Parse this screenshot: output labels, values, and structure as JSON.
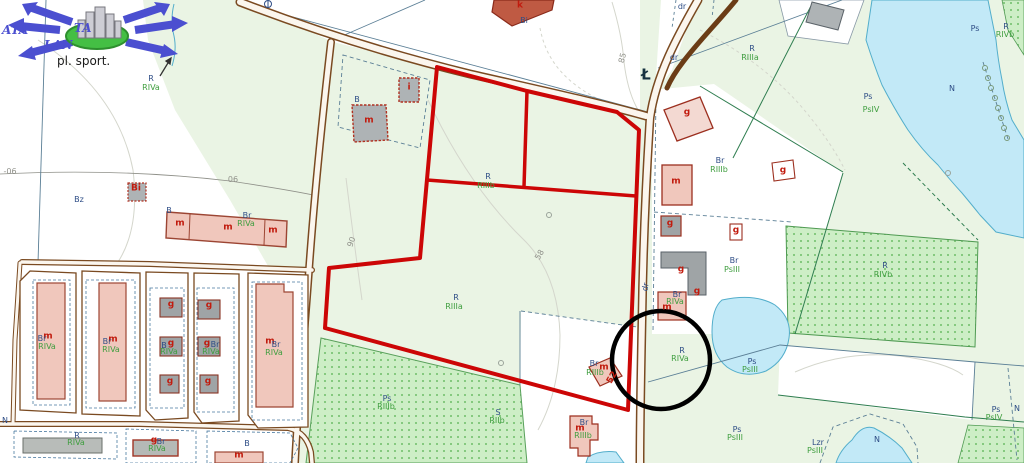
{
  "map": {
    "watermark": {
      "text_left": "ATA",
      "text_right": "TA",
      "text_mid": "LAN",
      "caption": "pl. sport."
    },
    "colors": {
      "parcel_outline": "#cc0606",
      "circle_annotation": "#000000",
      "road": "#7a4a21",
      "road_fill": "#fbf6ee",
      "water": "#c2e9f7",
      "water_edge": "#53aecb",
      "field_light": "#eaf4e4",
      "orchard_dot": "#85c97f",
      "building_pink": "#f0c7bc",
      "building_gray": "#aeb3b5",
      "label_blue": "#2e4d86",
      "label_green": "#3f9e3f",
      "label_red": "#c11b0e",
      "label_gray": "#8f9089",
      "logo_blue": "#4b4fd0",
      "logo_green": "#44bf44"
    },
    "labels": [
      {
        "t": "R",
        "x": 151,
        "y": 79,
        "c": "blue"
      },
      {
        "t": "RIVa",
        "x": 151,
        "y": 88,
        "c": "green"
      },
      {
        "t": "-06",
        "x": 10,
        "y": 172,
        "c": "gray"
      },
      {
        "t": "06",
        "x": 233,
        "y": 180,
        "c": "gray"
      },
      {
        "t": "Bz",
        "x": 79,
        "y": 200,
        "c": "blue"
      },
      {
        "t": "Bi",
        "x": 136,
        "y": 189,
        "c": "red"
      },
      {
        "t": "B",
        "x": 169,
        "y": 211,
        "c": "blue"
      },
      {
        "t": "m",
        "x": 180,
        "y": 224,
        "c": "red"
      },
      {
        "t": "m",
        "x": 228,
        "y": 228,
        "c": "red"
      },
      {
        "t": "m",
        "x": 273,
        "y": 231,
        "c": "red"
      },
      {
        "t": "Br",
        "x": 247,
        "y": 216,
        "c": "blue"
      },
      {
        "t": "RIVa",
        "x": 246,
        "y": 224,
        "c": "green"
      },
      {
        "t": "B",
        "x": 357,
        "y": 100,
        "c": "blue"
      },
      {
        "t": "i",
        "x": 409,
        "y": 88,
        "c": "red"
      },
      {
        "t": "m",
        "x": 369,
        "y": 121,
        "c": "red"
      },
      {
        "t": "k",
        "x": 520,
        "y": 6,
        "c": "red"
      },
      {
        "t": "Bi",
        "x": 524,
        "y": 21,
        "c": "blue"
      },
      {
        "t": "85",
        "x": 623,
        "y": 58,
        "c": "gray",
        "r": -75
      },
      {
        "t": "dr",
        "x": 682,
        "y": 7,
        "c": "blue"
      },
      {
        "t": "dr",
        "x": 674,
        "y": 58,
        "c": "blue"
      },
      {
        "t": "Ł",
        "x": 646,
        "y": 75,
        "c": "darklg"
      },
      {
        "t": "g",
        "x": 687,
        "y": 113,
        "c": "red"
      },
      {
        "t": "R",
        "x": 752,
        "y": 49,
        "c": "blue"
      },
      {
        "t": "RIIIa",
        "x": 750,
        "y": 58,
        "c": "green"
      },
      {
        "t": "m",
        "x": 676,
        "y": 182,
        "c": "red"
      },
      {
        "t": "Br",
        "x": 720,
        "y": 161,
        "c": "blue"
      },
      {
        "t": "RIIIb",
        "x": 719,
        "y": 170,
        "c": "green"
      },
      {
        "t": "g",
        "x": 783,
        "y": 171,
        "c": "red"
      },
      {
        "t": "g",
        "x": 670,
        "y": 224,
        "c": "red"
      },
      {
        "t": "g",
        "x": 736,
        "y": 231,
        "c": "red"
      },
      {
        "t": "Br",
        "x": 734,
        "y": 261,
        "c": "blue"
      },
      {
        "t": "PsIII",
        "x": 732,
        "y": 270,
        "c": "green"
      },
      {
        "t": "g",
        "x": 681,
        "y": 270,
        "c": "red"
      },
      {
        "t": "g",
        "x": 697,
        "y": 292,
        "c": "red"
      },
      {
        "t": "Br",
        "x": 677,
        "y": 295,
        "c": "blue"
      },
      {
        "t": "RIVa",
        "x": 675,
        "y": 302,
        "c": "green"
      },
      {
        "t": "m",
        "x": 667,
        "y": 308,
        "c": "red"
      },
      {
        "t": "dr",
        "x": 646,
        "y": 287,
        "c": "blue",
        "r": -80
      },
      {
        "t": "R",
        "x": 488,
        "y": 177,
        "c": "blue"
      },
      {
        "t": "RIIIb",
        "x": 486,
        "y": 186,
        "c": "green"
      },
      {
        "t": "R",
        "x": 456,
        "y": 298,
        "c": "blue"
      },
      {
        "t": "RIIIa",
        "x": 454,
        "y": 307,
        "c": "green"
      },
      {
        "t": "90",
        "x": 352,
        "y": 242,
        "c": "gray",
        "r": -70
      },
      {
        "t": "58",
        "x": 540,
        "y": 255,
        "c": "gray",
        "r": -60
      },
      {
        "t": "Ps",
        "x": 868,
        "y": 97,
        "c": "blue"
      },
      {
        "t": "PsIV",
        "x": 871,
        "y": 110,
        "c": "green"
      },
      {
        "t": "Ps",
        "x": 975,
        "y": 29,
        "c": "blue"
      },
      {
        "t": "R",
        "x": 1006,
        "y": 27,
        "c": "blue"
      },
      {
        "t": "RIVb",
        "x": 1005,
        "y": 35,
        "c": "green"
      },
      {
        "t": "N",
        "x": 952,
        "y": 89,
        "c": "blue"
      },
      {
        "t": "R",
        "x": 885,
        "y": 266,
        "c": "blue"
      },
      {
        "t": "RIVb",
        "x": 883,
        "y": 275,
        "c": "green"
      },
      {
        "t": "R",
        "x": 682,
        "y": 351,
        "c": "blue"
      },
      {
        "t": "RIVa",
        "x": 680,
        "y": 359,
        "c": "green"
      },
      {
        "t": "Ps",
        "x": 752,
        "y": 362,
        "c": "blue"
      },
      {
        "t": "PsIII",
        "x": 750,
        "y": 370,
        "c": "green"
      },
      {
        "t": "Ps",
        "x": 737,
        "y": 430,
        "c": "blue"
      },
      {
        "t": "PsIII",
        "x": 735,
        "y": 438,
        "c": "green"
      },
      {
        "t": "Lzr",
        "x": 818,
        "y": 443,
        "c": "blue"
      },
      {
        "t": "PsIII",
        "x": 815,
        "y": 451,
        "c": "green"
      },
      {
        "t": "N",
        "x": 877,
        "y": 440,
        "c": "blue"
      },
      {
        "t": "Ps",
        "x": 996,
        "y": 410,
        "c": "blue"
      },
      {
        "t": "PsIV",
        "x": 994,
        "y": 418,
        "c": "green"
      },
      {
        "t": "N",
        "x": 1017,
        "y": 409,
        "c": "blue"
      },
      {
        "t": "Br",
        "x": 594,
        "y": 364,
        "c": "blue"
      },
      {
        "t": "m",
        "x": 604,
        "y": 368,
        "c": "red"
      },
      {
        "t": "RIIIb",
        "x": 595,
        "y": 373,
        "c": "green"
      },
      {
        "t": "52",
        "x": 613,
        "y": 378,
        "c": "red",
        "r": -60
      },
      {
        "t": "Br",
        "x": 584,
        "y": 423,
        "c": "blue"
      },
      {
        "t": "m",
        "x": 580,
        "y": 429,
        "c": "red"
      },
      {
        "t": "RIIIb",
        "x": 583,
        "y": 436,
        "c": "green"
      },
      {
        "t": "Ps",
        "x": 387,
        "y": 399,
        "c": "blue"
      },
      {
        "t": "RIIIb",
        "x": 386,
        "y": 407,
        "c": "green"
      },
      {
        "t": "S",
        "x": 498,
        "y": 413,
        "c": "blue"
      },
      {
        "t": "RIIb",
        "x": 497,
        "y": 421,
        "c": "green"
      },
      {
        "t": "m",
        "x": 48,
        "y": 337,
        "c": "red"
      },
      {
        "t": "Br",
        "x": 42,
        "y": 339,
        "c": "blue"
      },
      {
        "t": "RIVa",
        "x": 47,
        "y": 347,
        "c": "green"
      },
      {
        "t": "m",
        "x": 113,
        "y": 340,
        "c": "red"
      },
      {
        "t": "Br",
        "x": 107,
        "y": 342,
        "c": "blue"
      },
      {
        "t": "RIVa",
        "x": 111,
        "y": 350,
        "c": "green"
      },
      {
        "t": "g",
        "x": 171,
        "y": 305,
        "c": "red"
      },
      {
        "t": "g",
        "x": 209,
        "y": 306,
        "c": "red"
      },
      {
        "t": "g",
        "x": 171,
        "y": 344,
        "c": "red"
      },
      {
        "t": "B",
        "x": 164,
        "y": 346,
        "c": "blue"
      },
      {
        "t": "RIVa",
        "x": 169,
        "y": 352,
        "c": "green"
      },
      {
        "t": "g",
        "x": 207,
        "y": 344,
        "c": "red"
      },
      {
        "t": "Br",
        "x": 215,
        "y": 345,
        "c": "blue"
      },
      {
        "t": "RIVa",
        "x": 211,
        "y": 352,
        "c": "green"
      },
      {
        "t": "g",
        "x": 170,
        "y": 382,
        "c": "red"
      },
      {
        "t": "g",
        "x": 208,
        "y": 382,
        "c": "red"
      },
      {
        "t": "m",
        "x": 270,
        "y": 342,
        "c": "red"
      },
      {
        "t": "Br",
        "x": 276,
        "y": 345,
        "c": "blue"
      },
      {
        "t": "RIVa",
        "x": 274,
        "y": 353,
        "c": "green"
      },
      {
        "t": "N",
        "x": 5,
        "y": 421,
        "c": "blue"
      },
      {
        "t": "R",
        "x": 77,
        "y": 436,
        "c": "blue"
      },
      {
        "t": "RIVa",
        "x": 76,
        "y": 443,
        "c": "green"
      },
      {
        "t": "g",
        "x": 154,
        "y": 441,
        "c": "red"
      },
      {
        "t": "Br",
        "x": 161,
        "y": 442,
        "c": "blue"
      },
      {
        "t": "RIVa",
        "x": 157,
        "y": 449,
        "c": "green"
      },
      {
        "t": "B",
        "x": 247,
        "y": 444,
        "c": "blue"
      },
      {
        "t": "m",
        "x": 239,
        "y": 456,
        "c": "red"
      }
    ]
  }
}
